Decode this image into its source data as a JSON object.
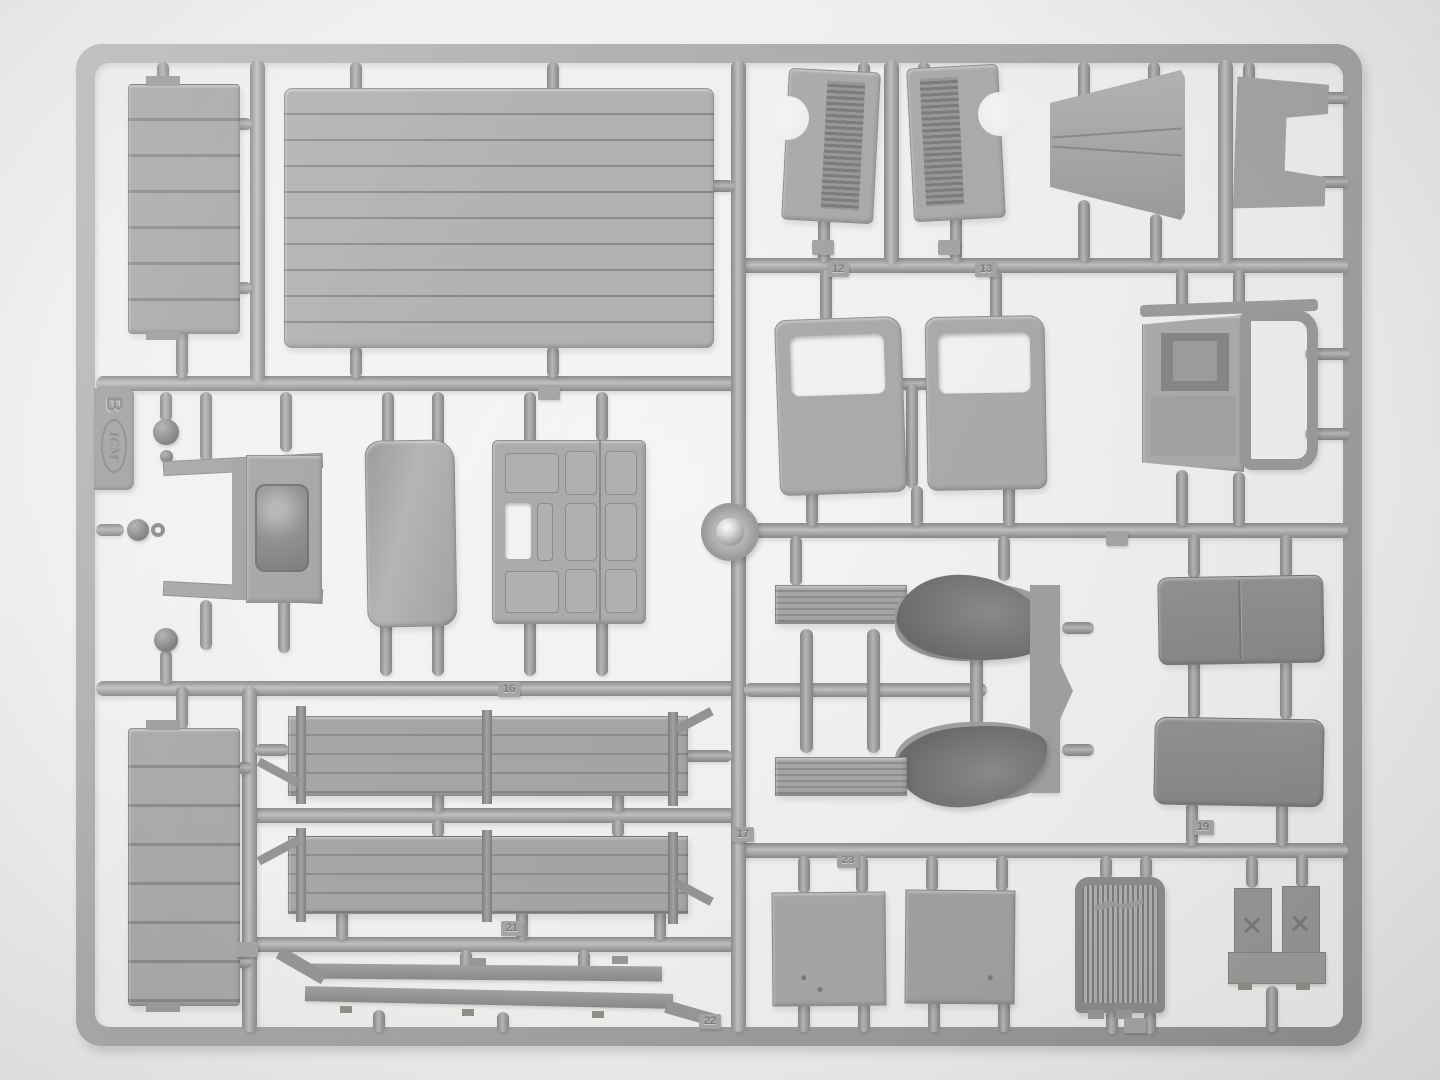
{
  "image": {
    "alt": "Grey plastic model kit sprue with truck parts photographed on a white background"
  },
  "sprue": {
    "brand": "ICM",
    "letter": "B"
  },
  "part_numbers": {
    "n12": "12",
    "n13": "13",
    "n16": "16",
    "n17": "17",
    "n19": "19",
    "n21": "21",
    "n22": "22",
    "n23": "23"
  },
  "colors": {
    "background": "#f2f0ee",
    "plastic_light": "#c2c1bf",
    "plastic_mid": "#adacaa",
    "plastic_dark": "#767573",
    "shadow": "rgba(0,0,0,0.12)"
  }
}
